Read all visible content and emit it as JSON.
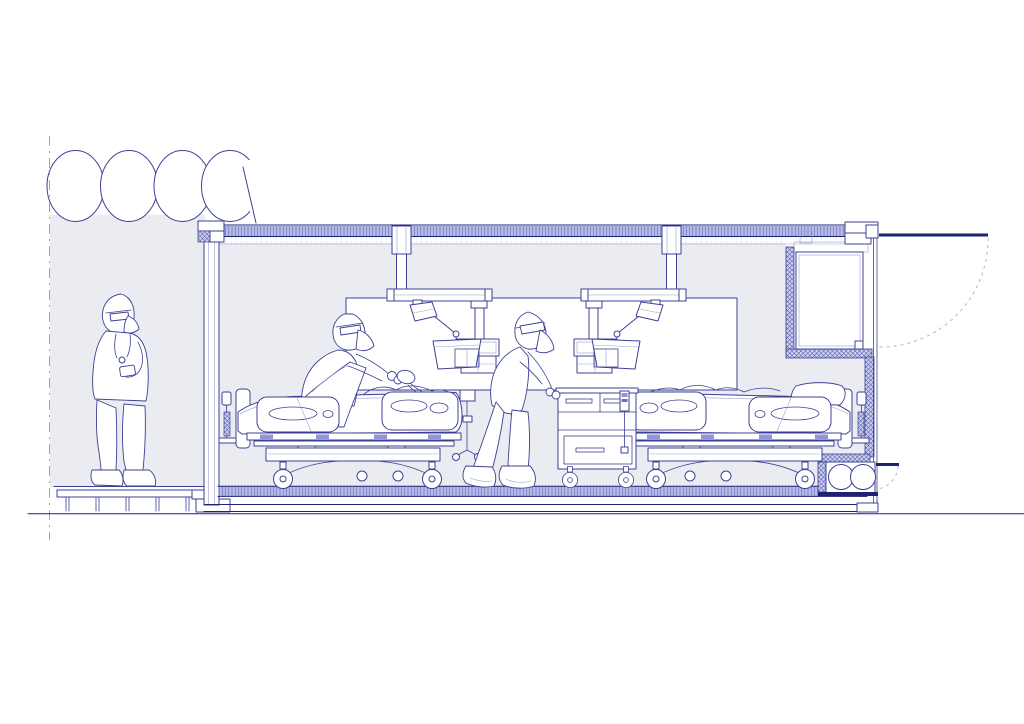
{
  "title": "Architectural section drawing of a containerized ICU module connected to an inflatable tent corridor",
  "canvas": {
    "width": 1024,
    "height": 724
  },
  "palette": {
    "paper": "#ffffff",
    "ink": "#3c4095",
    "ink-dark": "#1d2272",
    "ink-mid": "#6a6fb8",
    "ink-light": "#9ba0cf",
    "room": "#ebecf1",
    "hatch-bg": "#b7bbe7",
    "hatch-line": "#555bad",
    "accent": "#8f95d8",
    "dash": "#b6b9da"
  },
  "scene": {
    "structures": [
      {
        "name": "inflatable-tent",
        "label": "Inflatable tent corridor",
        "lobes": 4
      },
      {
        "name": "anteroom",
        "label": "Shaded anteroom between tent and container"
      },
      {
        "name": "entry-deck",
        "label": "Raised entry deck on joists"
      },
      {
        "name": "icu-container",
        "label": "Insulated ICU container module in section"
      },
      {
        "name": "interior-panel",
        "label": "Interior glazed wall panel"
      },
      {
        "name": "airlock-niche",
        "label": "Right-end insulated niche with outward-opening door"
      },
      {
        "name": "door-swing",
        "label": "Dashed quarter-circle door swing arc"
      },
      {
        "name": "utility-compartment",
        "label": "Under-floor utility compartment",
        "cylinders": 2
      }
    ],
    "equipment": [
      {
        "name": "ceiling-pendant-1",
        "label": "Ceiling pendant with boom, exam lamp, monitor and shelf"
      },
      {
        "name": "ceiling-pendant-2",
        "label": "Mirrored ceiling pendant with boom, exam lamp, monitor and shelf"
      },
      {
        "name": "icu-bed-1",
        "label": "ICU bed with side rails, patient with backrest raised"
      },
      {
        "name": "icu-bed-2",
        "label": "ICU bed with side rails, supine patient"
      },
      {
        "name": "supply-cart",
        "label": "Bedside supply cabinet on casters with syringe pump"
      },
      {
        "name": "equipment-stand",
        "label": "Rolling equipment stand"
      }
    ],
    "people": [
      {
        "name": "clinician-anteroom",
        "label": "Clinician in full PPE standing on deck checking device"
      },
      {
        "name": "clinician-bed-1",
        "label": "Clinician in PPE ventilating patient at head of bed 1"
      },
      {
        "name": "clinician-cart",
        "label": "Clinician in PPE leaning over supply cart"
      }
    ],
    "counts": {
      "beds": 2,
      "clinicians": 3,
      "pendants": 2,
      "tent_lobes": 4,
      "gas_cylinders": 2
    }
  }
}
